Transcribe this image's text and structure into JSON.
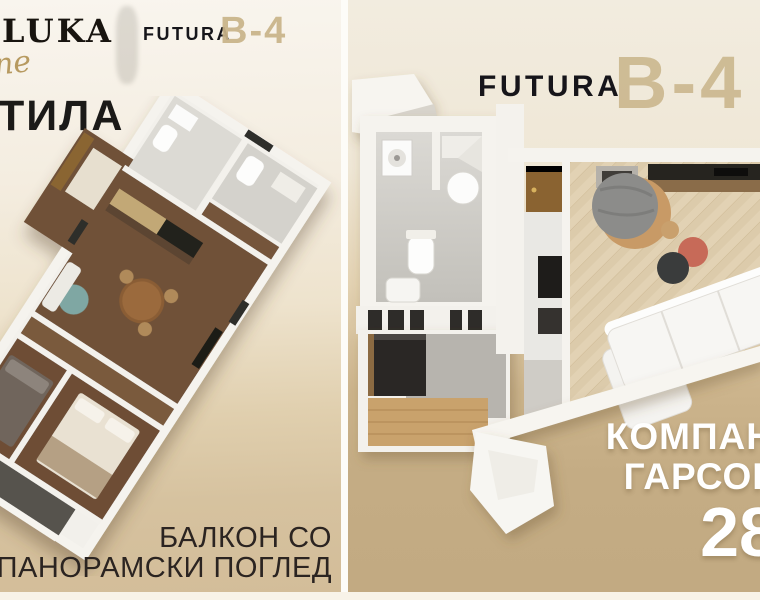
{
  "left_panel": {
    "brand_serif": "LUKA",
    "brand_script": "ne",
    "brand_name": "FUTURA",
    "unit_label": "B-4",
    "headline_fragment": "ТИЛА",
    "caption_line1": "БАЛКОН СО",
    "caption_line2": "ПАНОРАМСКИ ПОГЛЕД"
  },
  "right_panel": {
    "brand_name": "FUTURA",
    "unit_label": "B-4",
    "caption_line1": "КОМПАН",
    "caption_line2": "ГАРСОН",
    "area_value": "28"
  },
  "colors": {
    "accent_beige": "#c9b489",
    "background_cream": "#f2ecdf",
    "background_tan": "#c2aa82",
    "caption_dark": "#2b2421",
    "caption_white": "#ffffff"
  }
}
